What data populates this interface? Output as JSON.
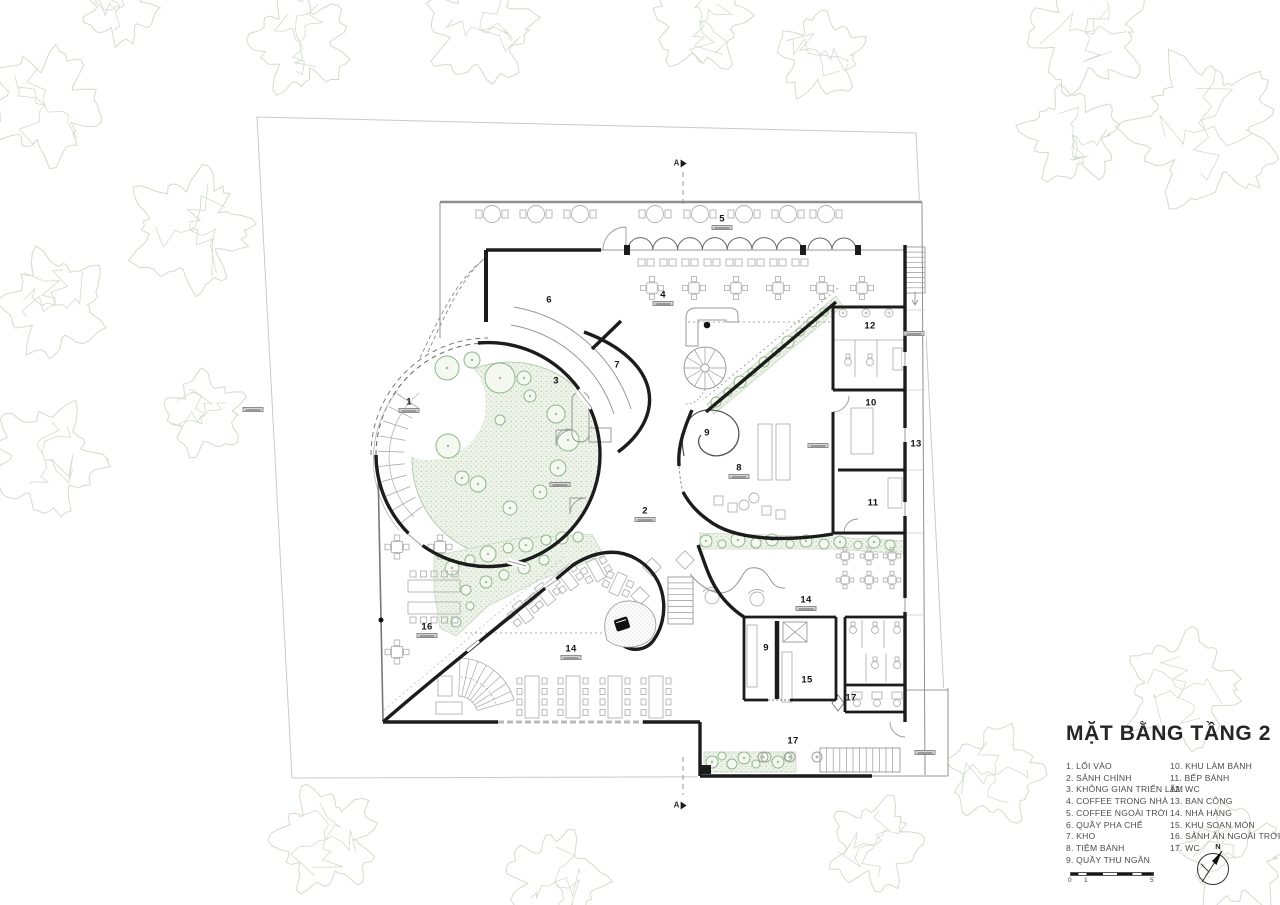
{
  "title": "MẶT BẰNG TẦNG 2",
  "legend_col1": [
    "1. LỐI VÀO",
    "2. SẢNH CHÍNH",
    "3. KHÔNG GIAN TRIỂN LÃM",
    "4. COFFEE TRONG NHÀ",
    "5. COFFEE NGOÀI TRỜI",
    "6. QUẦY PHA CHẾ",
    "7. KHO",
    "8. TIỆM BÁNH",
    "9. QUẦY THU NGÂN"
  ],
  "legend_col2": [
    "10. KHU LÀM BÁNH",
    "11. BẾP BÁNH",
    "12. WC",
    "13. BAN CÔNG",
    "14. NHÀ HÀNG",
    "15. KHU SOẠN MÓN",
    "16. SẢNH ĂN NGOÀI TRỜI",
    "17. WC"
  ],
  "room_labels": [
    {
      "n": "1",
      "x": 409,
      "y": 402,
      "chip": true
    },
    {
      "n": "2",
      "x": 645,
      "y": 511,
      "chip": true
    },
    {
      "n": "3",
      "x": 556,
      "y": 381,
      "chip": false
    },
    {
      "n": "4",
      "x": 663,
      "y": 295,
      "chip": true
    },
    {
      "n": "5",
      "x": 722,
      "y": 219,
      "chip": true
    },
    {
      "n": "6",
      "x": 549,
      "y": 300,
      "chip": false
    },
    {
      "n": "7",
      "x": 617,
      "y": 365,
      "chip": false
    },
    {
      "n": "8",
      "x": 739,
      "y": 468,
      "chip": true
    },
    {
      "n": "9",
      "x": 707,
      "y": 433,
      "chip": false
    },
    {
      "n": "9",
      "x": 766,
      "y": 648,
      "chip": false
    },
    {
      "n": "10",
      "x": 871,
      "y": 403,
      "chip": false
    },
    {
      "n": "11",
      "x": 873,
      "y": 503,
      "chip": false
    },
    {
      "n": "12",
      "x": 870,
      "y": 326,
      "chip": false
    },
    {
      "n": "13",
      "x": 916,
      "y": 444,
      "chip": false
    },
    {
      "n": "14",
      "x": 806,
      "y": 600,
      "chip": true
    },
    {
      "n": "14",
      "x": 571,
      "y": 649,
      "chip": true
    },
    {
      "n": "15",
      "x": 807,
      "y": 680,
      "chip": false
    },
    {
      "n": "16",
      "x": 427,
      "y": 627,
      "chip": true
    },
    {
      "n": "17",
      "x": 851,
      "y": 698,
      "chip": false
    },
    {
      "n": "17",
      "x": 793,
      "y": 741,
      "chip": false
    }
  ],
  "floating_badges": [
    {
      "x": 253,
      "y": 407
    },
    {
      "x": 914,
      "y": 331
    },
    {
      "x": 818,
      "y": 443
    },
    {
      "x": 925,
      "y": 750
    },
    {
      "x": 560,
      "y": 482
    }
  ],
  "section_markers": [
    {
      "label": "A",
      "x": 680,
      "y": 163
    },
    {
      "label": "A",
      "x": 680,
      "y": 805
    }
  ],
  "scale_bar": {
    "ticks": [
      "0",
      "1",
      "5"
    ]
  },
  "north_label": "N",
  "colors": {
    "wall": "#1c1c1c",
    "light_wall": "#979797",
    "outline_gray": "#8f8f8f",
    "furniture": "#b3b3b3",
    "green_stroke": "#8fb88a",
    "green_fill": "#eef3ea",
    "tree_outline": "#d2dccd",
    "site_line": "#c9c9c9",
    "text_dark": "#262626",
    "text_gray": "#4c4c4c"
  }
}
